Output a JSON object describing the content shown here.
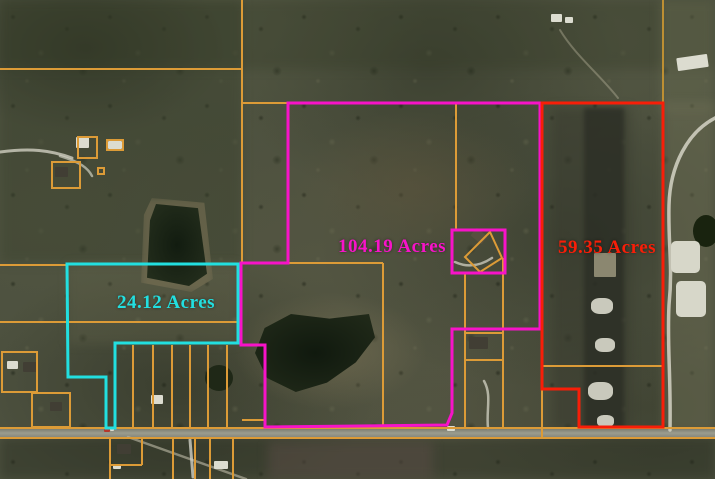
{
  "parcels": [
    {
      "id": "teal",
      "label": "24.12 Acres",
      "color": "#22dfe0"
    },
    {
      "id": "magenta",
      "label": "104.19 Acres",
      "color": "#f713c8"
    },
    {
      "id": "red",
      "label": "59.35 Acres",
      "color": "#f81e08"
    }
  ],
  "cadastral": {
    "primary_color": "#dc9b37",
    "secondary_color": "#bd8f33"
  },
  "road": {
    "surface_color": "#90927f"
  }
}
